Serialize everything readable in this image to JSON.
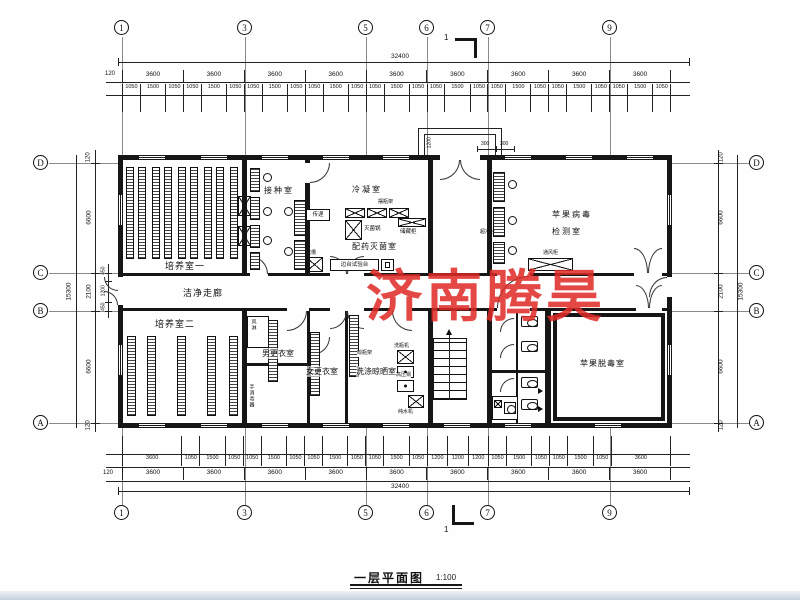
{
  "watermark": "济南腾昊",
  "watermark_color": "#e02a25",
  "title": {
    "name": "一层平面图",
    "scale": "1:100"
  },
  "section_mark": "1",
  "grid": {
    "top": [
      "1",
      "3",
      "5",
      "6",
      "7",
      "9"
    ],
    "bottom": [
      "1",
      "3",
      "5",
      "6",
      "7",
      "9"
    ],
    "left": [
      "D",
      "C",
      "B",
      "A"
    ],
    "right": [
      "D",
      "C",
      "B",
      "A"
    ]
  },
  "dims": {
    "overall_h": "32400",
    "overall_v": "15300",
    "offset": "120",
    "top_bays": [
      "3600",
      "3600",
      "3600",
      "3600",
      "3600",
      "3600",
      "3600",
      "3600",
      "3600"
    ],
    "top_windows": [
      "1050",
      "1500",
      "1050",
      "1050",
      "1500",
      "1050",
      "1050",
      "1500",
      "1050",
      "1050",
      "1500",
      "1050",
      "1050",
      "1500",
      "1050",
      "1050",
      "1500",
      "1050",
      "1050",
      "1500",
      "1050",
      "1050",
      "1500",
      "1050",
      "1050",
      "1500",
      "1050"
    ],
    "bottom_fine": [
      "3600",
      "1050",
      "1500",
      "1050",
      "1050",
      "1500",
      "1050",
      "1050",
      "1500",
      "1050",
      "1050",
      "1500",
      "1050",
      "1200",
      "1200",
      "1200",
      "1050",
      "1500",
      "1050",
      "1050",
      "1500",
      "1050",
      "3600"
    ],
    "bottom_bays": [
      "3600",
      "3600",
      "3600",
      "3600",
      "3600",
      "3600",
      "3600",
      "3600",
      "3600"
    ],
    "left_main": [
      "6600",
      "2100",
      "6600"
    ],
    "left_sub": [
      "450",
      "1200",
      "450"
    ],
    "right_main": [
      "6600",
      "2100",
      "6600"
    ],
    "entrance": {
      "depth": "1200",
      "left": "300",
      "right": "300"
    }
  },
  "rooms": {
    "culture1": "培养室一",
    "inoculation": "接种室",
    "condensation": "冷凝室",
    "prep": "配药灭菌室",
    "virus_test_line1": "苹果病毒",
    "virus_test_line2": "检测室",
    "corridor": "洁净走廊",
    "culture2": "培养室二",
    "men_changing": "男更衣室",
    "women_changing": "女更衣室",
    "washing": "洗涤晾晒室",
    "detox": "苹果脱毒室"
  },
  "equipment": {
    "pass_window": "传递",
    "sterilizer": "灭菌锅",
    "bottle_shelf": "摆瓶架",
    "storage": "储藏柜",
    "sink": "洗槽",
    "side_bench": "边台试验台",
    "clean_bench": "超净台",
    "fume_hood": "通风柜",
    "air_shower": "风淋",
    "bottle_washer": "洗瓶机",
    "autoclave": "高压锅",
    "water_purifier": "纯水机",
    "hand_sanitizer": "手消毒器",
    "drying_rack": "晾瓶架"
  }
}
